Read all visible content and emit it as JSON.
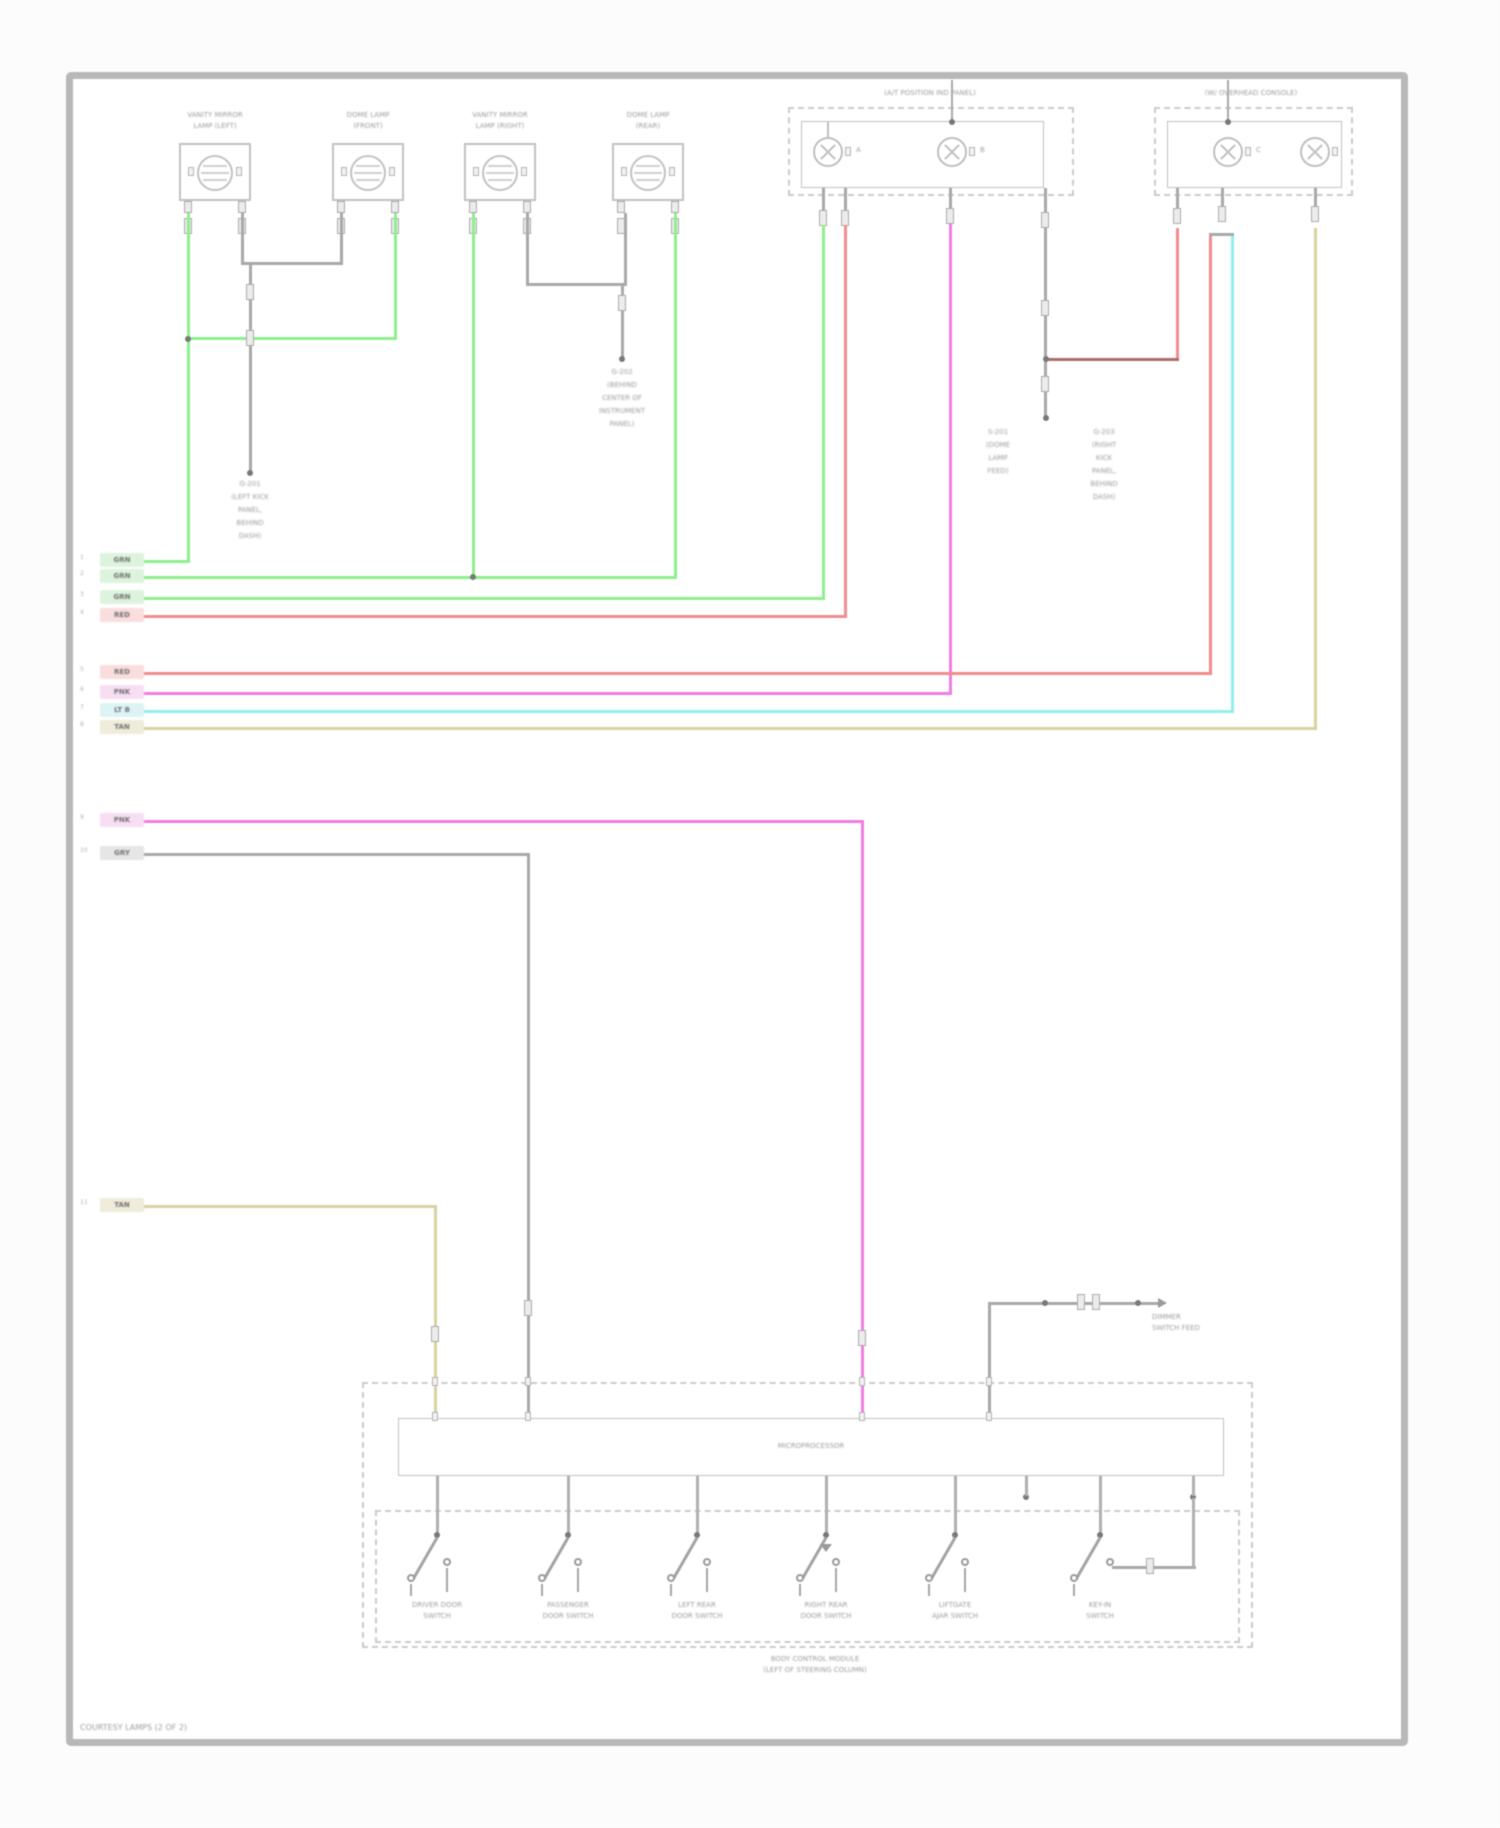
{
  "footer": "COURTESY LAMPS (2 OF 2)",
  "colors": {
    "green": "#8df08d",
    "red": "#f28c8c",
    "magenta": "#f07ce2",
    "cyan": "#8fefef",
    "tan": "#d9d1a0",
    "gray": "#a8a8a8",
    "darkred": "#b06a6a"
  },
  "lamps": [
    {
      "line1": "VANITY MIRROR",
      "line2": "LAMP (LEFT)"
    },
    {
      "line1": "DOME LAMP",
      "line2": "(FRONT)"
    },
    {
      "line1": "VANITY MIRROR",
      "line2": "LAMP (RIGHT)"
    },
    {
      "line1": "DOME LAMP",
      "line2": "(REAR)"
    }
  ],
  "panel1": {
    "label": "(A/T POSITION IND PANEL)",
    "bulb_a": "A",
    "bulb_b": "B"
  },
  "panel2": {
    "label": "(W/ OVERHEAD CONSOLE)",
    "bulb_a": "C"
  },
  "grounds": {
    "left": {
      "lines": [
        "G-201",
        "(LEFT KICK",
        "PANEL,",
        "BEHIND",
        "DASH)"
      ]
    },
    "mid": {
      "lines": [
        "G-202",
        "(BEHIND",
        "CENTER OF",
        "INSTRUMENT",
        "PANEL)"
      ]
    },
    "splice": {
      "lines": [
        "S-201",
        "(DOME",
        "LAMP",
        "FEED)"
      ]
    },
    "right": {
      "lines": [
        "G-203",
        "(RIGHT",
        "KICK",
        "PANEL,",
        "BEHIND",
        "DASH)"
      ]
    }
  },
  "stubs": {
    "group1": [
      {
        "pin": "1",
        "code": "GRN"
      },
      {
        "pin": "2",
        "code": "GRN"
      },
      {
        "pin": "3",
        "code": "GRN"
      },
      {
        "pin": "4",
        "code": "RED"
      }
    ],
    "group2": [
      {
        "pin": "5",
        "code": "RED"
      },
      {
        "pin": "6",
        "code": "PNK"
      },
      {
        "pin": "7",
        "code": "LT B"
      },
      {
        "pin": "8",
        "code": "TAN"
      }
    ],
    "pink": {
      "pin": "9",
      "code": "PNK"
    },
    "gray": {
      "pin": "10",
      "code": "GRY"
    },
    "tan": {
      "pin": "11",
      "code": "TAN"
    }
  },
  "module": {
    "label": "MICROPROCESSOR",
    "caption1": "BODY CONTROL MODULE",
    "caption2": "(LEFT OF STEERING COLUMN)",
    "switches": [
      {
        "line1": "DRIVER DOOR",
        "line2": "SWITCH"
      },
      {
        "line1": "PASSENGER",
        "line2": "DOOR SWITCH"
      },
      {
        "line1": "LEFT REAR",
        "line2": "DOOR SWITCH"
      },
      {
        "line1": "RIGHT REAR",
        "line2": "DOOR SWITCH"
      },
      {
        "line1": "LIFTGATE",
        "line2": "AJAR SWITCH"
      },
      {
        "line1": "KEY-IN",
        "line2": "SWITCH"
      }
    ]
  },
  "component": {
    "line1": "DIMMER",
    "line2": "SWITCH FEED"
  }
}
